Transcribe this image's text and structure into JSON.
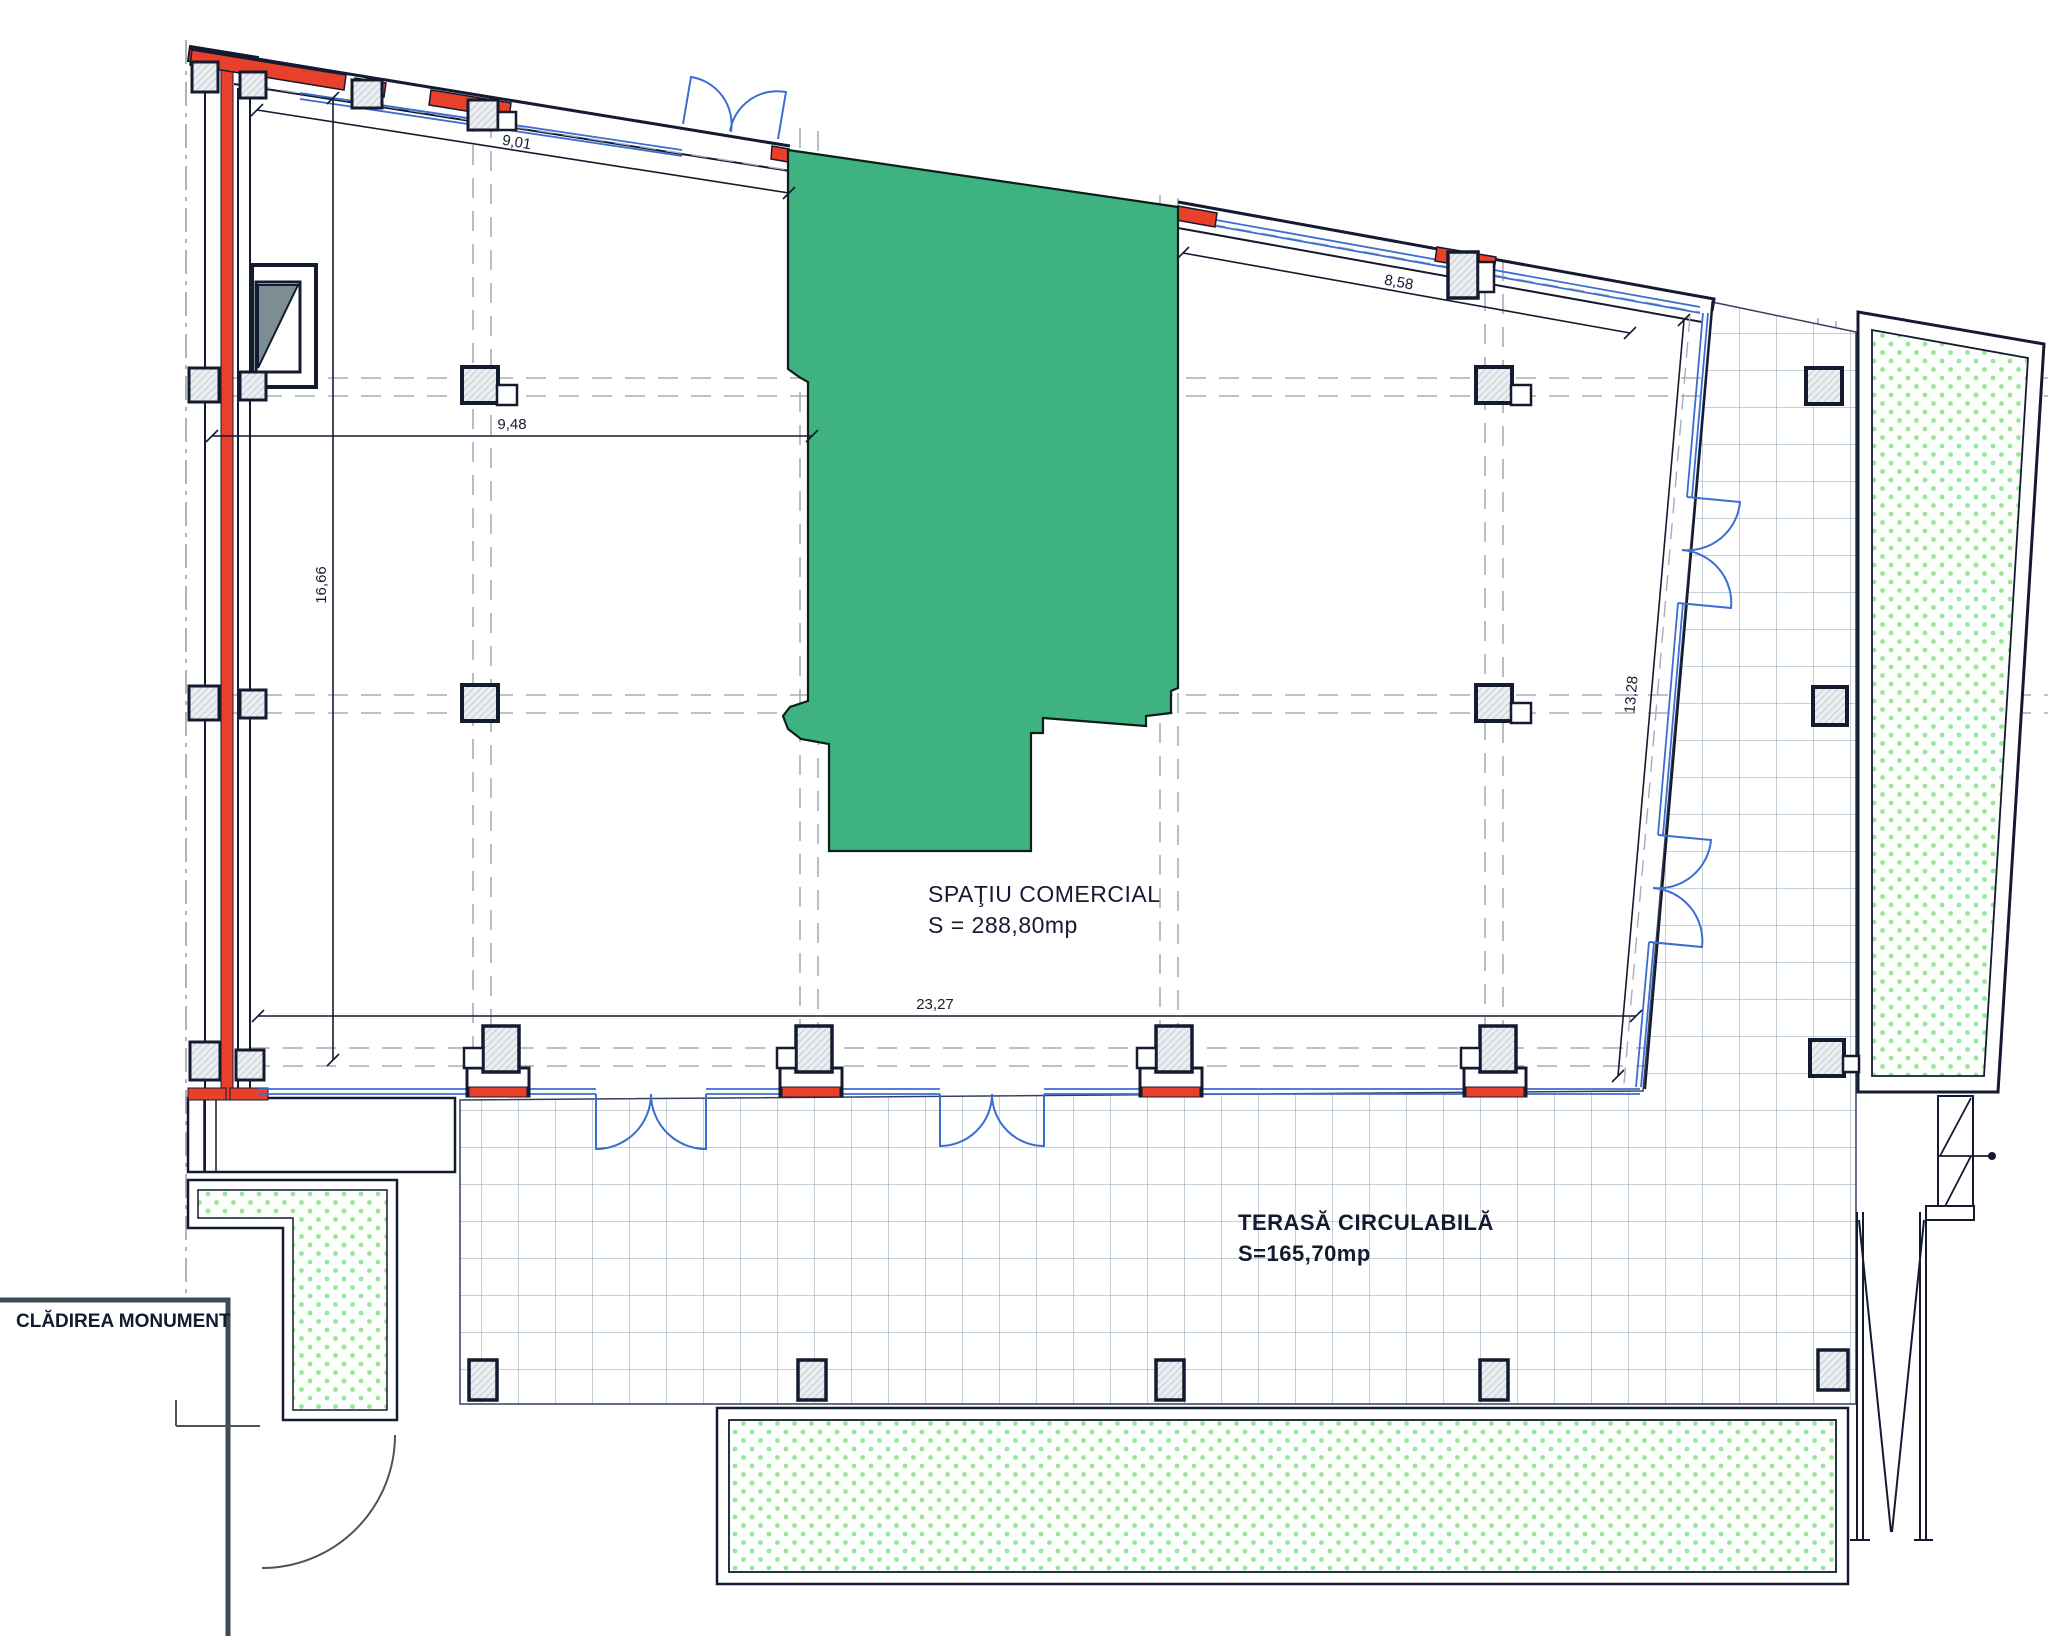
{
  "rooms": {
    "commercial": {
      "name": "SPAŢIU COMERCIAL",
      "area": "S = 288,80mp"
    },
    "terrace": {
      "name": "TERASĂ CIRCULABILĂ",
      "area": "S=165,70mp"
    },
    "monument": {
      "name": "CLĂDIREA MONUMENT"
    }
  },
  "dimensions": {
    "top_left_wall": "9,01",
    "top_right_wall": "8,58",
    "interior_width": "9,48",
    "interior_height_left": "16,66",
    "right_wall": "13,28",
    "bottom_wall": "23,27"
  },
  "colors": {
    "commercial_fill": "#3eb381",
    "wall_red": "#e8402b",
    "door_blue": "#3a6ed2",
    "line_dark": "#141a30",
    "planting_dots": "#98e698",
    "tile_grid": "#8ba1b7"
  }
}
